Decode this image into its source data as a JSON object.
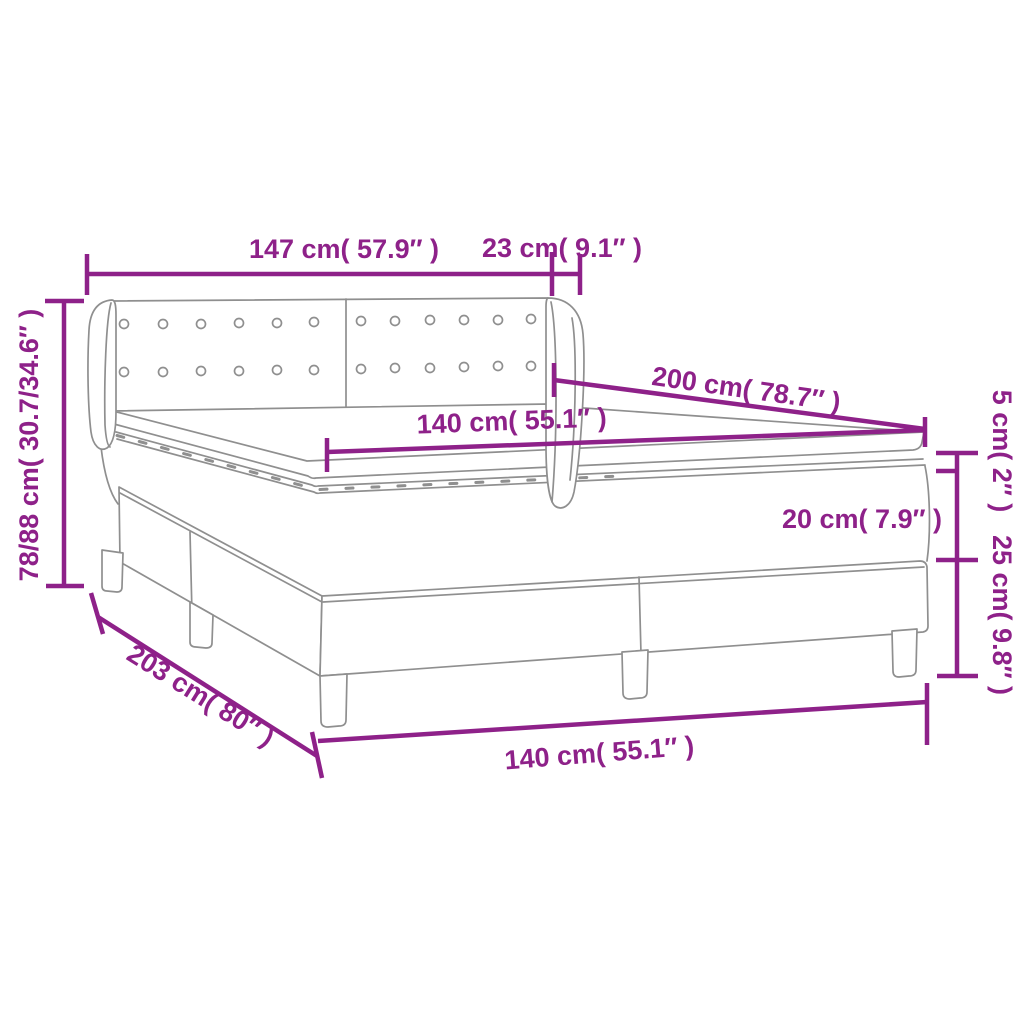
{
  "diagram": {
    "type": "product-dimension-diagram",
    "subject": "box spring bed with tufted winged headboard, mattress and topper",
    "colors": {
      "dimension_lines": "#8E2189",
      "drawing_lines": "#8F8F8F",
      "background": "#FFFFFF"
    },
    "labels": {
      "headboard_width": "147 cm( 57.9″ )",
      "wing_depth": "23 cm( 9.1″ )",
      "headboard_height": "78/88 cm( 30.7/34.6″ )",
      "bed_length": "200 cm( 78.7″ )",
      "mattress_width": "140 cm( 55.1″ )",
      "topper_thickness": "5 cm( 2″ )",
      "mattress_thickness": "20 cm( 7.9″ )",
      "base_height": "25 cm( 9.8″ )",
      "overall_length": "203 cm( 80″ )",
      "base_width": "140 cm( 55.1″ )"
    }
  }
}
